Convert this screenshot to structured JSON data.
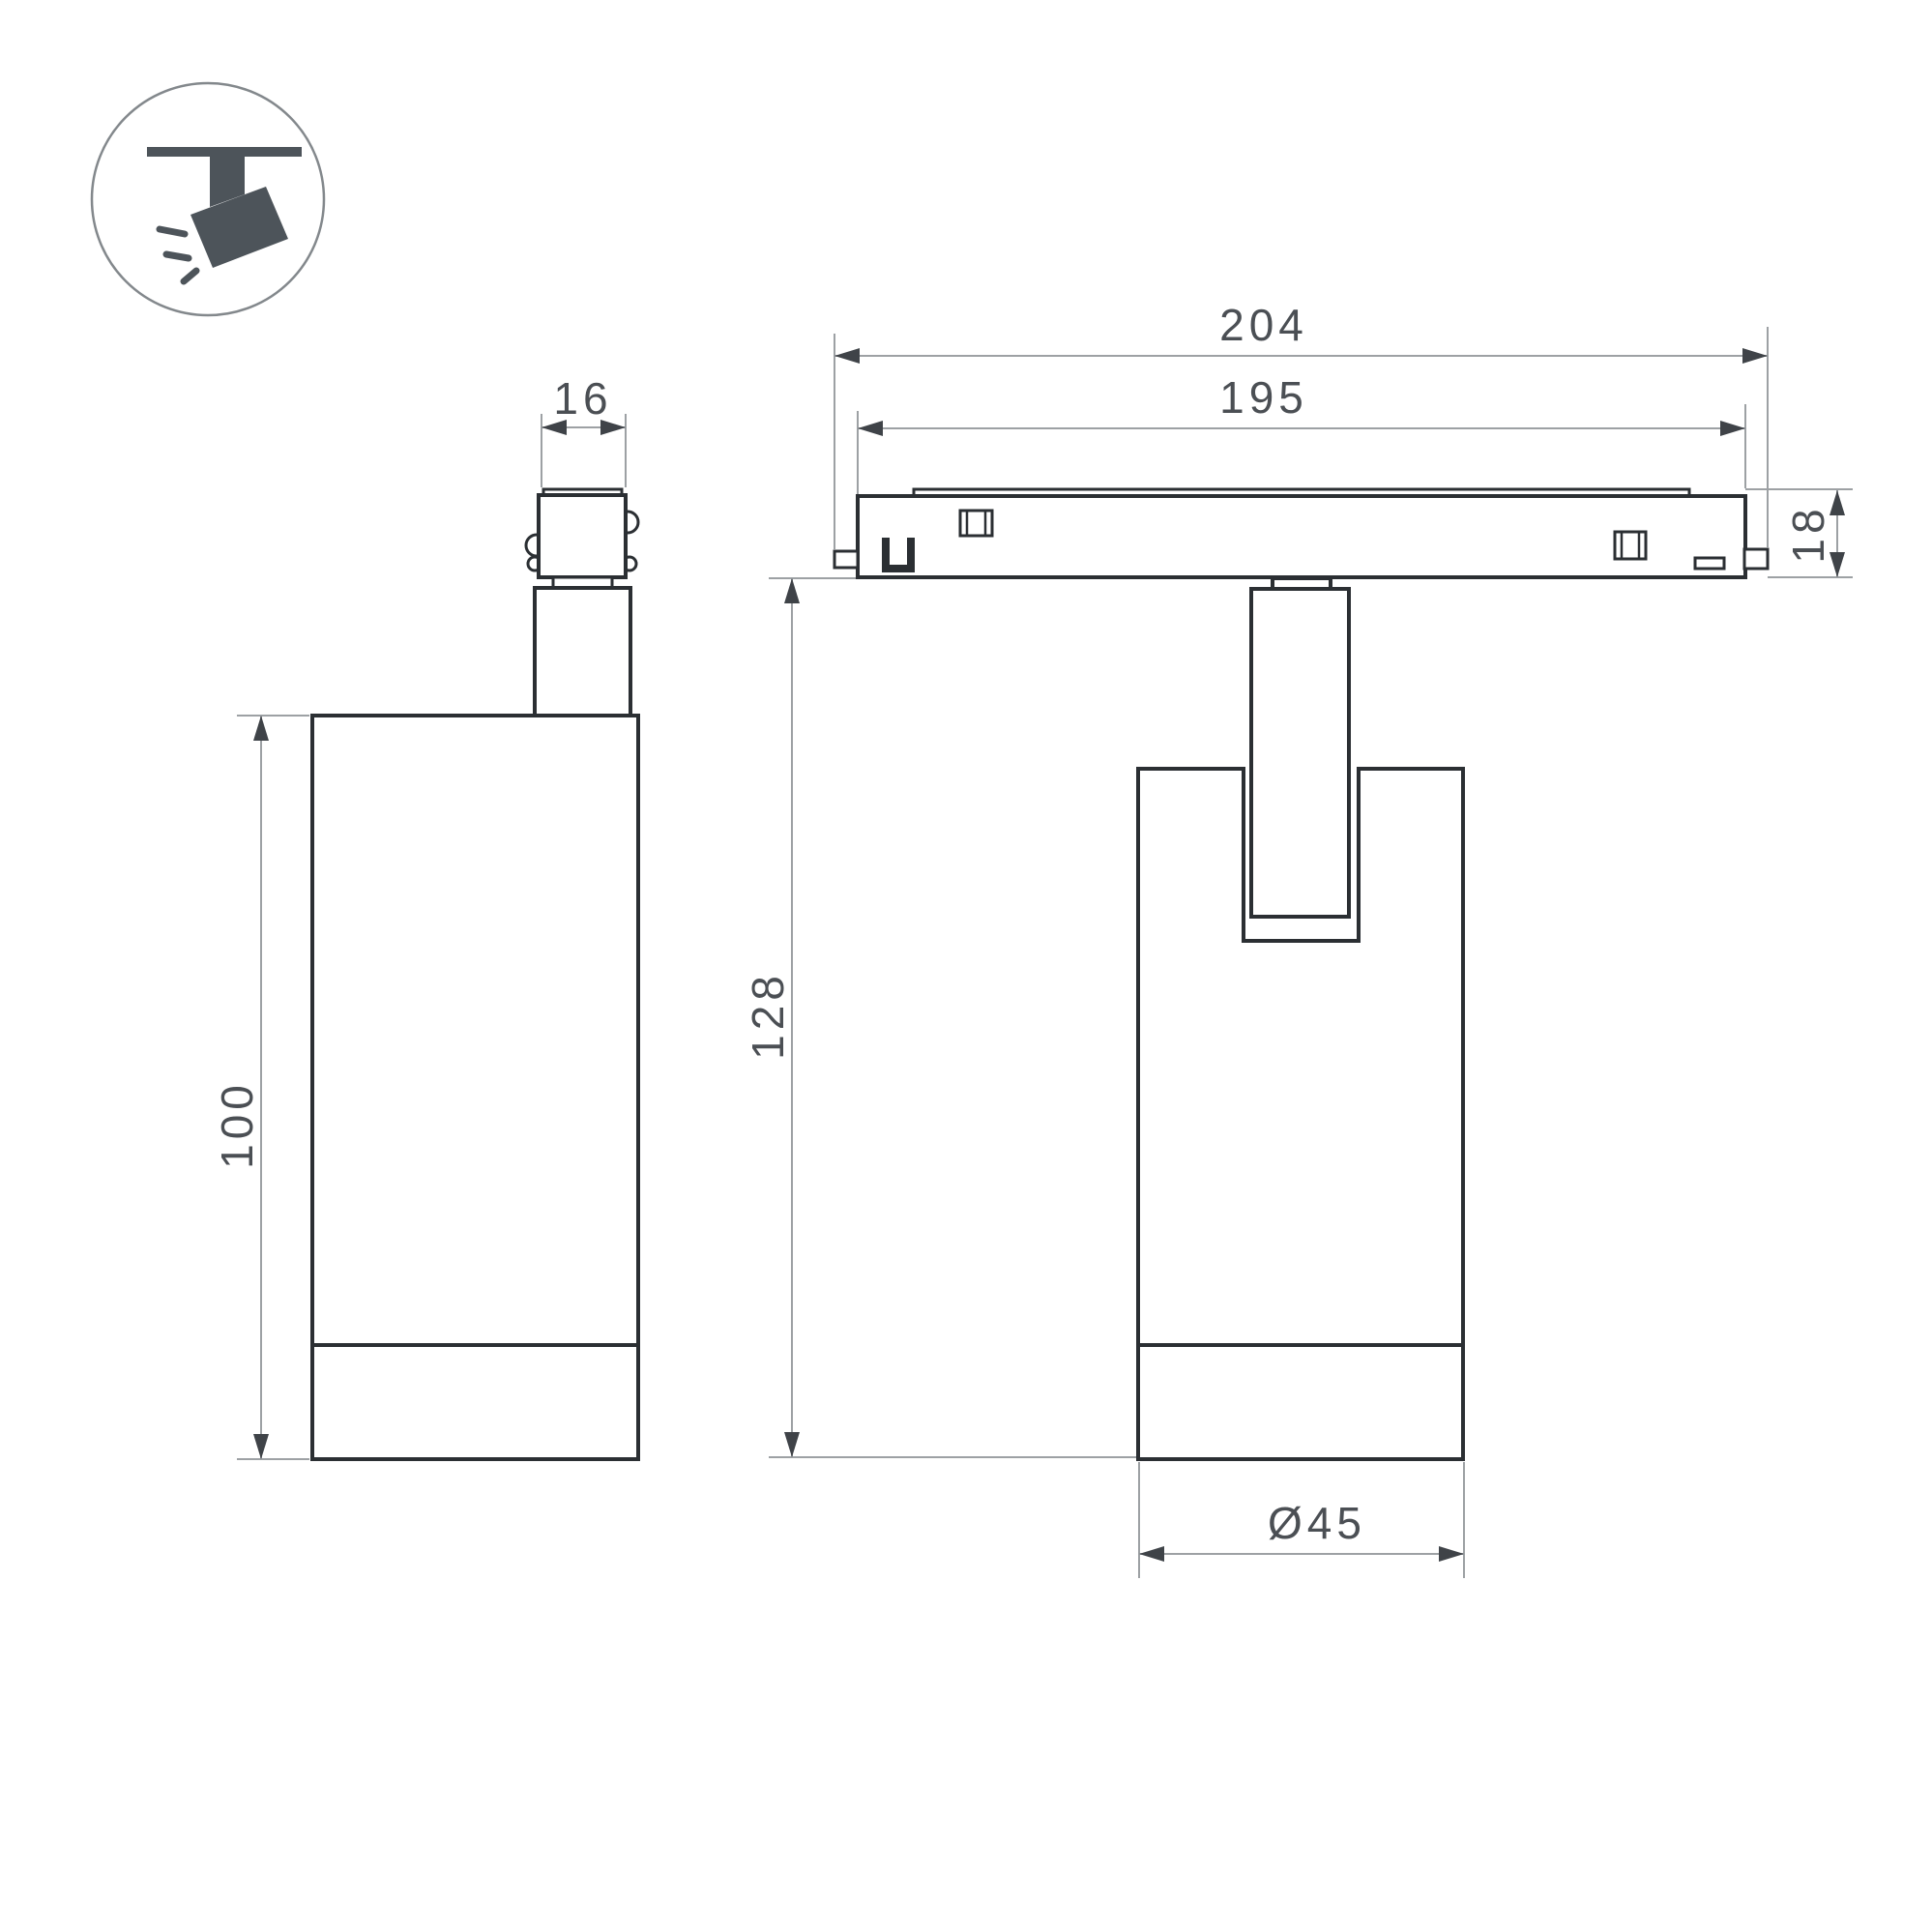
{
  "icon": {
    "name": "track-spotlight-pictogram"
  },
  "views": {
    "side_view": "side view of track spotlight",
    "front_view": "front view of track spotlight on track"
  },
  "dimensions": {
    "connector_width": "16",
    "track_overall_length": "204",
    "track_visible_length": "195",
    "track_height": "18",
    "housing_height": "100",
    "overall_drop_height": "128",
    "housing_diameter": "Ø45"
  },
  "colors": {
    "outline": "#2b2f33",
    "dimension_line": "#9da1a4",
    "dimension_text": "#4b4f54",
    "icon_fill": "#4d545a",
    "background": "#ffffff"
  }
}
